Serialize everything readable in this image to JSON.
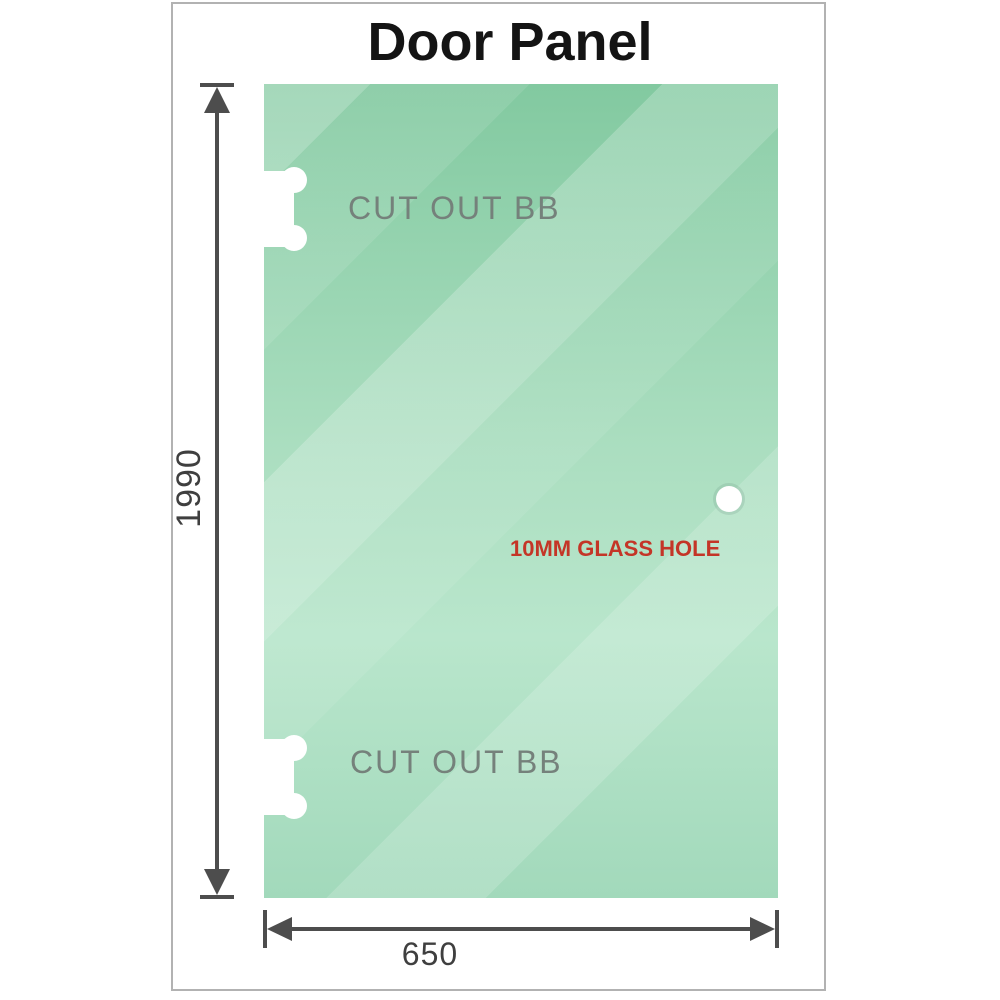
{
  "title": "Door Panel",
  "panel": {
    "cutout_top_label": "CUT OUT BB",
    "cutout_bottom_label": "CUT OUT BB",
    "glass_hole_label": "10MM GLASS HOLE"
  },
  "dimensions": {
    "height": "1990",
    "width": "650"
  },
  "colors": {
    "glass_green_dark": "#82c9a0",
    "glass_green_light": "#b9e6cc",
    "dimension_line": "#4d4d4d",
    "cutout_label": "#75817b",
    "glass_hole_label": "#c43527",
    "frame_border": "#b2b2b2",
    "title": "#141414"
  }
}
